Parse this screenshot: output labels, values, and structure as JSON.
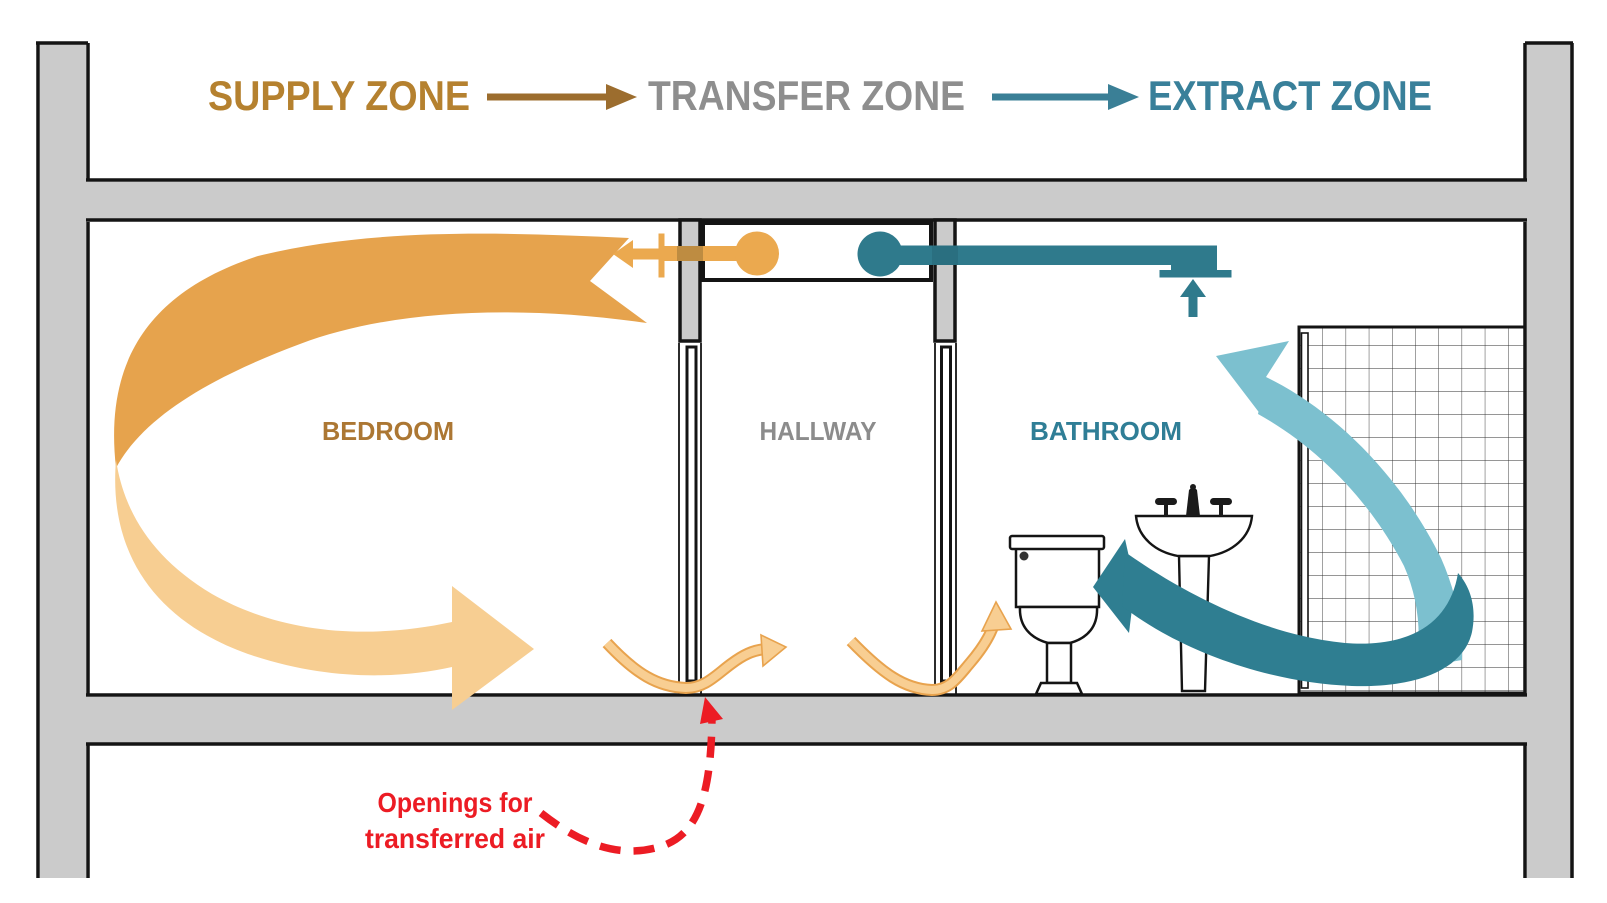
{
  "header": {
    "supply_label": "SUPPLY ZONE",
    "transfer_label": "TRANSFER ZONE",
    "extract_label": "EXTRACT ZONE"
  },
  "rooms": {
    "bedroom_label": "BEDROOM",
    "hallway_label": "HALLWAY",
    "bathroom_label": "BATHROOM"
  },
  "annotation": {
    "line1": "Openings for",
    "line2": "transferred air"
  },
  "icons": {
    "supply_header_arrow": "right-arrow",
    "extract_header_arrow": "right-arrow",
    "supply_duct": "supply-air-duct-with-left-arrow",
    "extract_duct": "extract-air-duct-with-up-arrow",
    "supply_circulation_arrow": "c-shaped-airflow-arrow",
    "extract_circulation_arrow": "j-shaped-airflow-arrow",
    "transfer_ribbons": "wavy-undercut-airflow-arrows",
    "callout_arrow": "red-dashed-curved-arrow",
    "fixtures": [
      "toilet",
      "pedestal-sink",
      "tiled-shower"
    ]
  },
  "colors": {
    "wall_gray": "#CBCBCB",
    "outline": "#141414",
    "supply_text": "#B5812F",
    "supply_arrow": "#9C6D2E",
    "transfer_text": "#8E8E8E",
    "extract_text": "#39809A",
    "extract_arrow": "#3A7F96",
    "duct_orange": "#EBA94F",
    "duct_orange_overlap": "#BE8C41",
    "arc_orange_dark": "#E6A34D",
    "arc_orange_light": "#F7CE92",
    "ribbon_fill": "#F8CE92",
    "ribbon_stroke": "#E8A34E",
    "duct_teal": "#2F7A8C",
    "duct_teal_overlap": "#2A6F80",
    "swoosh_teal_dark": "#2F7E91",
    "swoosh_teal_light": "#7CC0CF",
    "bedroom_text": "#AC7733",
    "hallway_text": "#8C8C8C",
    "bathroom_text": "#2F7E96",
    "annotation_red": "#EC1C24"
  }
}
